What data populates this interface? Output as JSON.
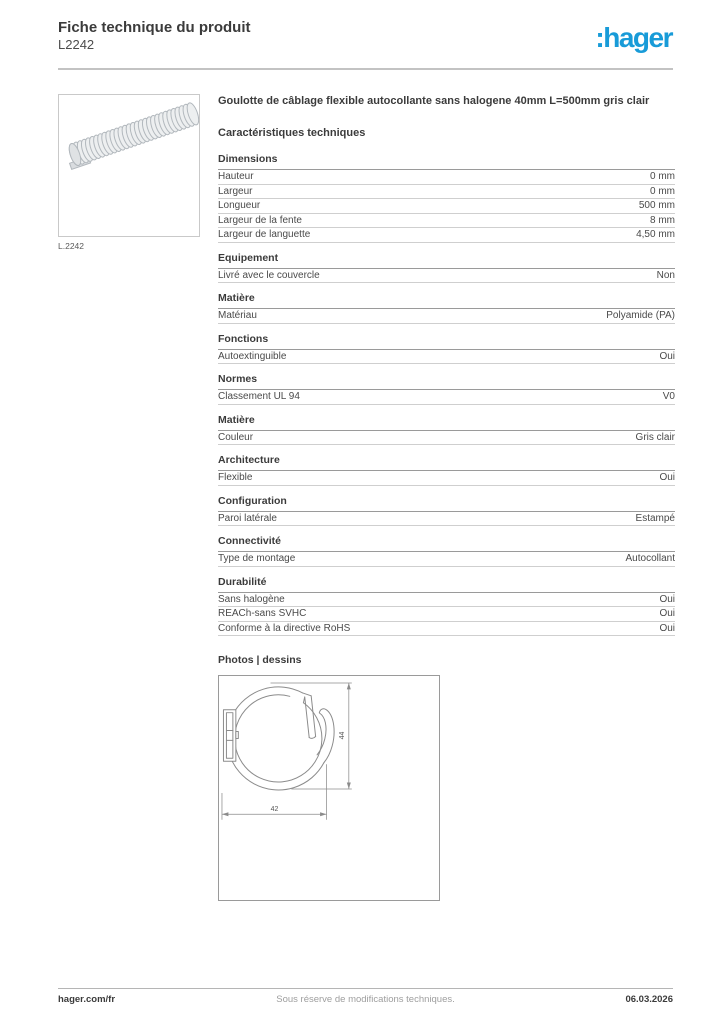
{
  "header": {
    "title": "Fiche technique du produit",
    "product_ref": "L2242",
    "logo_text": ":hager",
    "brand_color": "#189bd8"
  },
  "product": {
    "image_caption": "L.2242",
    "name": "Goulotte de câblage flexible autocollante sans halogene 40mm L=500mm gris clair"
  },
  "characteristics": {
    "heading": "Caractéristiques techniques",
    "sections": [
      {
        "title": "Dimensions",
        "rows": [
          [
            "Hauteur",
            "0 mm"
          ],
          [
            "Largeur",
            "0 mm"
          ],
          [
            "Longueur",
            "500 mm"
          ],
          [
            "Largeur de la fente",
            "8 mm"
          ],
          [
            "Largeur de languette",
            "4,50 mm"
          ]
        ]
      },
      {
        "title": "Equipement",
        "rows": [
          [
            "Livré avec le couvercle",
            "Non"
          ]
        ]
      },
      {
        "title": "Matière",
        "rows": [
          [
            "Matériau",
            "Polyamide (PA)"
          ]
        ]
      },
      {
        "title": "Fonctions",
        "rows": [
          [
            "Autoextinguible",
            "Oui"
          ]
        ]
      },
      {
        "title": "Normes",
        "rows": [
          [
            "Classement UL 94",
            "V0"
          ]
        ]
      },
      {
        "title": "Matière",
        "rows": [
          [
            "Couleur",
            "Gris clair"
          ]
        ]
      },
      {
        "title": "Architecture",
        "rows": [
          [
            "Flexible",
            "Oui"
          ]
        ]
      },
      {
        "title": "Configuration",
        "rows": [
          [
            "Paroi latérale",
            "Estampé"
          ]
        ]
      },
      {
        "title": "Connectivité",
        "rows": [
          [
            "Type de montage",
            "Autocollant"
          ]
        ]
      },
      {
        "title": "Durabilité",
        "rows": [
          [
            "Sans halogène",
            "Oui"
          ],
          [
            "REACh-sans SVHC",
            "Oui"
          ],
          [
            "Conforme à la directive RoHS",
            "Oui"
          ]
        ]
      }
    ]
  },
  "photos": {
    "heading": "Photos | dessins",
    "drawing": {
      "width_label": "42",
      "height_label": "44"
    }
  },
  "footer": {
    "site": "hager.com/fr",
    "disclaimer": "Sous réserve de modifications techniques.",
    "date": "06.03.2026"
  }
}
